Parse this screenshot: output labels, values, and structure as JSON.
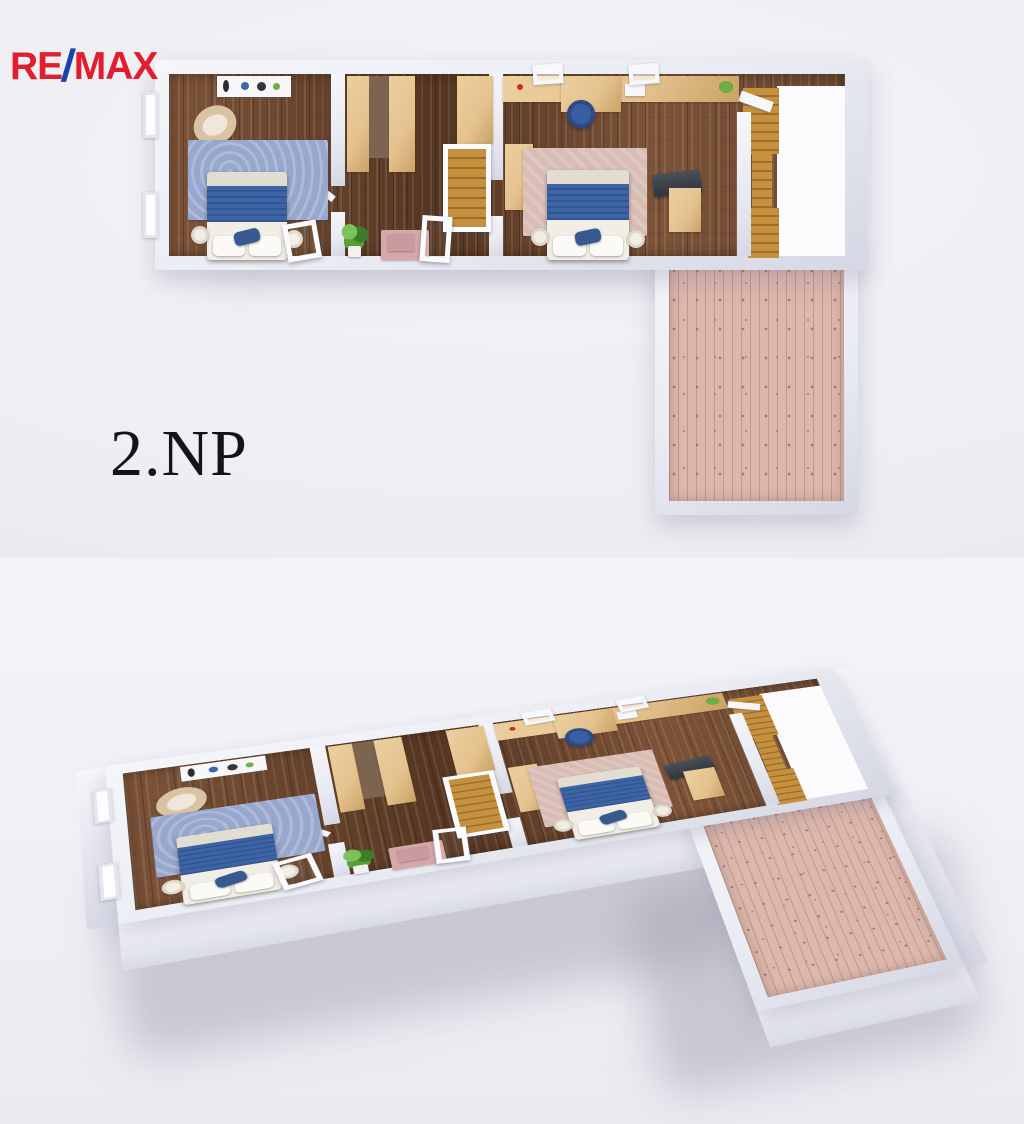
{
  "logo": {
    "re": "RE",
    "slash": "/",
    "max": "MAX"
  },
  "floor_label": "2.NP",
  "palette": {
    "remax-red": "#e11e2d",
    "remax-blue": "#1744a8",
    "ink": "#141414",
    "bg": "#f1f0f5",
    "wall": "#e9ebf3",
    "wood": "#6b4730",
    "beige": "#e4c28e",
    "rug-blue": "#97a7cd",
    "bed-blue": "#3d64a7",
    "linen": "#f1eee6",
    "rug-pink": "#d9bdb5",
    "stair": "#c6913f",
    "terrace": "#dcb7ac",
    "plant": "#57a037",
    "tv": "#30363e"
  }
}
